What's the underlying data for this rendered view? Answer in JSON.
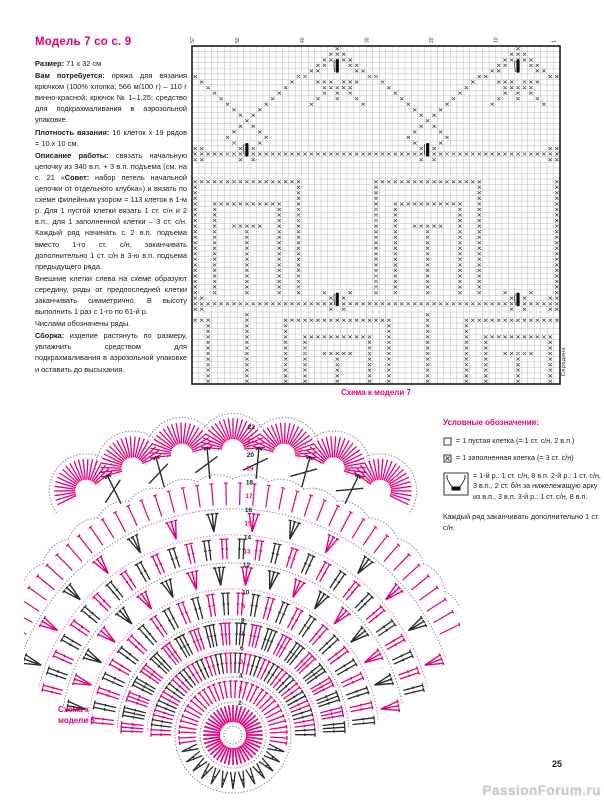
{
  "page": {
    "page_number": "25",
    "watermark": "PassionForum.ru"
  },
  "colors": {
    "accent": "#e2007a",
    "pink": "#e4007c",
    "black": "#2d2d2d",
    "grid_line": "#b3b3b3",
    "grid_border": "#1c1c1c",
    "dot_gray": "#8f8f8f",
    "dot_pink": "#ea7fc0"
  },
  "article": {
    "title": "Модель 7 со с. 9",
    "paragraphs": [
      {
        "runs": [
          {
            "b": true,
            "t": "Размер:"
          },
          {
            "b": false,
            "t": " 71 х 32 см"
          }
        ]
      },
      {
        "runs": [
          {
            "b": true,
            "t": "Вам потребуется:"
          },
          {
            "b": false,
            "t": " пряжа для вязания крючком (100% хлопка; 566 м/100 г) – 110 г винно-красной; крючок № 1–1,25; средство для подкрахмаливания в аэрозольной упаковке."
          }
        ]
      },
      {
        "runs": [
          {
            "b": true,
            "t": "Плотность вязания:"
          },
          {
            "b": false,
            "t": " 16 клеток х 19 рядов = 10 х 10 см."
          }
        ]
      },
      {
        "runs": [
          {
            "b": true,
            "t": "Описание работы:"
          },
          {
            "b": false,
            "t": " связать начальную цепочку из 340 в.п. + 3 в.п. подъема (см. на с. 21 «"
          },
          {
            "b": true,
            "t": "Совет:"
          },
          {
            "b": false,
            "t": " набор петель начальной цепочки от отдельного клубка») и вязать по схеме филейным узором = 113 клеток в 1-м р. Для 1 пустой клетки вязать 1 ст. с/н и 2 в.п., для 1 заполненной клетки – 3 ст. с/н. Каждый ряд начинать с 2 в.п. подъема вместо 1-го ст. с/н, заканчивать дополнительно 1 ст. с/н в 3-ю в.п. подъема предыдущего ряда."
          }
        ]
      },
      {
        "runs": [
          {
            "b": false,
            "t": "Внешние клетки слева на схеме образуют середину, ряды от предпоследней клетки заканчивать симметрично. В высоту выполнить 1 раз с 1-го по 61-й р."
          }
        ]
      },
      {
        "runs": [
          {
            "b": false,
            "t": "Числами обозначены ряды."
          }
        ]
      },
      {
        "runs": [
          {
            "b": true,
            "t": "Сборка:"
          },
          {
            "b": false,
            "t": " изделие растянуть по размеру, увлажнить средством для подкрахмаливания в аэрозольной упаковке и оставить до высыхания."
          }
        ]
      }
    ]
  },
  "filet_chart": {
    "caption": "Схема к модели 7",
    "side_label": "Середина",
    "top_labels": [
      {
        "c": 0,
        "t": "57"
      },
      {
        "c": 7,
        "t": "50"
      },
      {
        "c": 17,
        "t": "40"
      },
      {
        "c": 27,
        "t": "30"
      },
      {
        "c": 37,
        "t": "20"
      },
      {
        "c": 47,
        "t": "10"
      },
      {
        "c": 56,
        "t": "1"
      }
    ],
    "grid": {
      "cols": 57,
      "rows": 61,
      "tier1_centers": [
        22,
        50,
        -6
      ],
      "tier2_centers": [
        8,
        36,
        64
      ],
      "tier3_centers": [
        22,
        50,
        -6
      ],
      "fence_rows": [
        19,
        46
      ],
      "fence_goblets": {
        "19": [
          8,
          36
        ],
        "46": [
          22,
          50
        ]
      }
    }
  },
  "legend": {
    "title": "Условные обозначения:",
    "items": [
      {
        "symbol": "empty-cell",
        "text": "= 1 пустая клетка (= 1 ст. с/н, 2 в.п.)"
      },
      {
        "symbol": "filled-cell",
        "text": "= 1 заполненная клетка (= 3 ст. с/н)"
      },
      {
        "symbol": "arc-cluster",
        "text": "= 1-й р.: 1 ст. с/н, 8 в.п. 2-й р.: 1 ст. с/н, 3 в.п., 2 ст. б/н за нижележащую арку из в.п., 3 в.п. 3-й р.: 1 ст. с/н, 8 в.п."
      }
    ],
    "footnote": "Каждый ряд заканчивать дополнительно 1 ст. с/н."
  },
  "doily": {
    "caption_line1": "Схема к",
    "caption_line2": "модели 6",
    "numbers": {
      "from": 2,
      "to": 22,
      "angle_deg": 2,
      "r0": 32,
      "step": 13.8
    },
    "rings": [
      {
        "kind": "dotcircle",
        "r": 9,
        "span": 360,
        "color": "gray"
      },
      {
        "kind": "spokes",
        "r1": 13,
        "r2": 30,
        "count": 44,
        "span": 360,
        "color": "pink",
        "w": 1.7
      },
      {
        "kind": "dotcircle",
        "r": 33,
        "span": 360,
        "color": "gray"
      },
      {
        "kind": "ring2",
        "r1": 37,
        "r2": 54,
        "count": 30,
        "span": 360
      },
      {
        "kind": "dotcircle",
        "r": 58,
        "span": 360,
        "color": "gray"
      },
      {
        "kind": "tt",
        "r1": 62,
        "r2": 82,
        "count": 26,
        "span": 176,
        "colors": "alt"
      },
      {
        "kind": "dotcircle",
        "r": 86,
        "span": 176,
        "color": "pinkdot"
      },
      {
        "kind": "tt3",
        "r1": 90,
        "r2": 112,
        "count": 22,
        "span": 172,
        "colors": "alt"
      },
      {
        "kind": "dotcircle",
        "r": 116,
        "span": 172,
        "color": "gray"
      },
      {
        "kind": "tt",
        "r1": 120,
        "r2": 142,
        "count": 28,
        "span": 168,
        "colors": "alt"
      },
      {
        "kind": "dotcircle",
        "r": 146,
        "span": 168,
        "color": "pinkdot"
      },
      {
        "kind": "broom",
        "r1": 150,
        "r2": 168,
        "count": 18,
        "span": 160,
        "colors": "alt"
      },
      {
        "kind": "dotcircle",
        "r": 172,
        "span": 160,
        "color": "gray"
      },
      {
        "kind": "tt",
        "r1": 176,
        "r2": 196,
        "count": 30,
        "span": 152,
        "colors": "alt"
      },
      {
        "kind": "dotcircle",
        "r": 200,
        "span": 152,
        "color": "pinkdot"
      },
      {
        "kind": "broom",
        "r1": 204,
        "r2": 222,
        "count": 14,
        "span": 140,
        "colors": "alt"
      },
      {
        "kind": "dotcircle",
        "r": 226,
        "span": 140,
        "color": "gray"
      },
      {
        "kind": "spokes",
        "r1": 230,
        "r2": 252,
        "count": 40,
        "span": 128,
        "color": "pink",
        "w": 1.2,
        "tick": true
      },
      {
        "kind": "scallop",
        "r": 256,
        "span": 128,
        "count": 16,
        "color": "gray"
      }
    ],
    "fans": {
      "count": 7,
      "r": 285,
      "span": 62,
      "stroke_count": 21,
      "inner": 11,
      "outer": 32,
      "arc_r": 37
    }
  }
}
